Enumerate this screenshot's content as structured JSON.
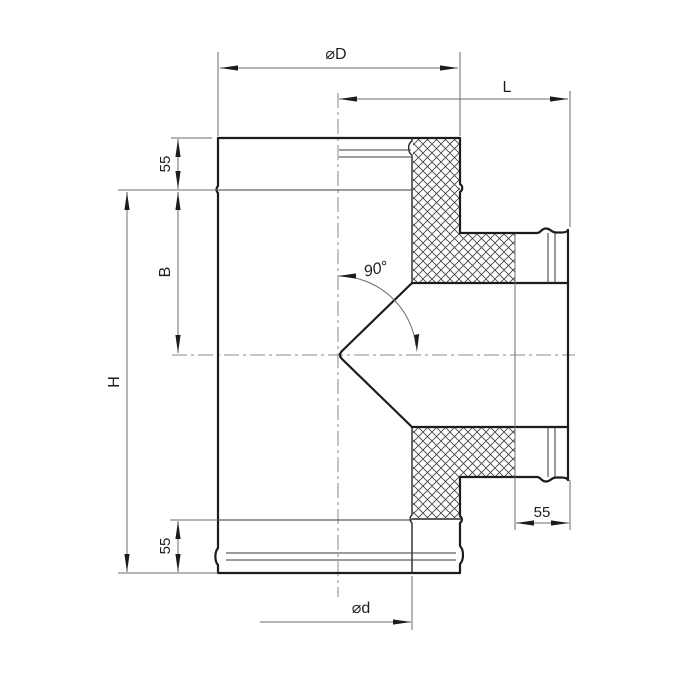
{
  "drawing": {
    "title": "90-degree sandwich tee chimney fitting — half-section dimensional drawing",
    "labels": {
      "outer_diameter": "⌀D",
      "length": "L",
      "socket_top": "55",
      "branch_center": "B",
      "height": "H",
      "socket_bottom": "55",
      "socket_branch": "55",
      "inner_diameter": "⌀d",
      "branch_angle": "90°"
    },
    "colors": {
      "background": "#ffffff",
      "outline": "#1c1c1c",
      "dimension_lines": "#6b6b6b",
      "centerlines": "#8a8a8a",
      "hatch": "#3d3d3d"
    }
  }
}
